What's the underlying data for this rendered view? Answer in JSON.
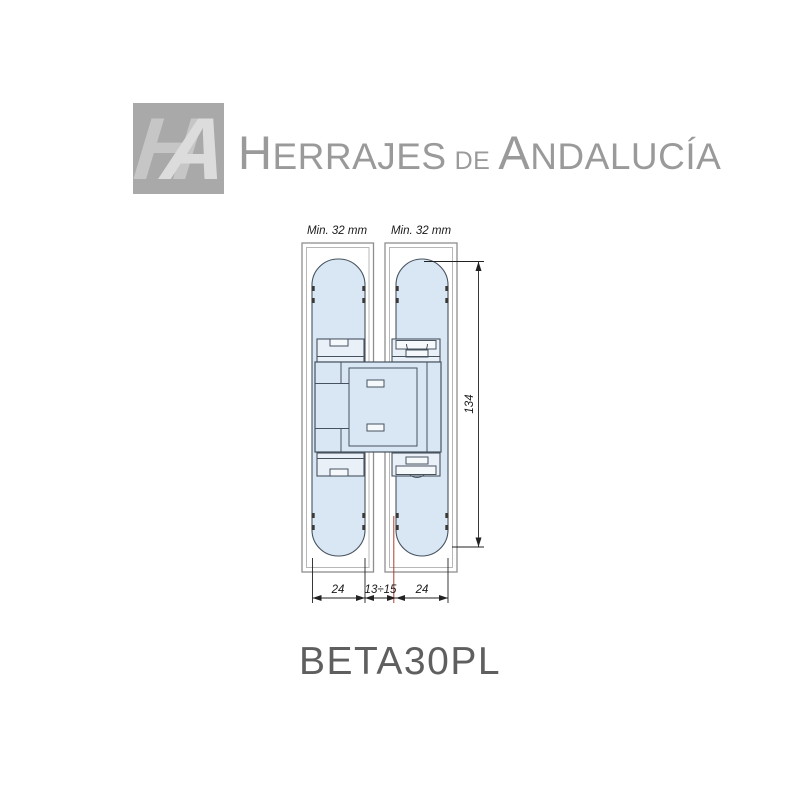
{
  "logo": {
    "mark_h": "H",
    "mark_a": "A",
    "word1_initial": "H",
    "word1_rest": "ERRAJES",
    "connector": "DE",
    "word2_initial": "A",
    "word2_rest": "NDALUCÍA"
  },
  "drawing": {
    "labels": {
      "min_width_left": "Min. 32 mm",
      "min_width_right": "Min. 32 mm",
      "height": "134",
      "width_left": "24",
      "gap": "13÷15",
      "width_right": "24"
    },
    "colors": {
      "leaf_fill": "#d9e7f4",
      "outline": "#46525e",
      "dimension": "#222222",
      "axis_red": "#b03a2e"
    }
  },
  "product": {
    "name": "BETA30PL"
  }
}
